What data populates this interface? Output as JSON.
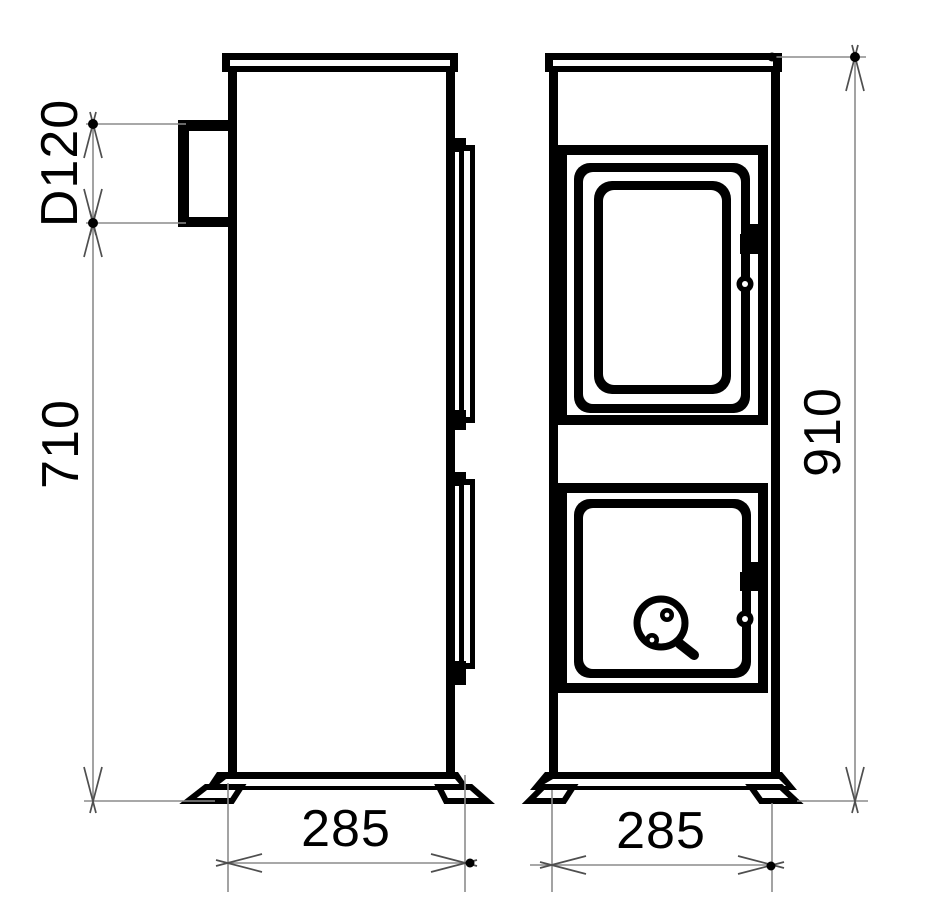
{
  "drawing": {
    "subject": "Two-view technical dimension drawing of a tall wood-burning stove",
    "views": [
      {
        "id": "side-view",
        "description": "left: side elevation with flue outlet collar and door edge profiles"
      },
      {
        "id": "front-view",
        "description": "right: front elevation with glazed upper door and lower ash door with air control knob"
      }
    ]
  },
  "dimensions": {
    "flue_diameter": {
      "label": "D120",
      "value": 120
    },
    "flue_height": {
      "label": "710",
      "value": 710
    },
    "overall_height": {
      "label": "910",
      "value": 910
    },
    "depth": {
      "label": "285",
      "value": 285
    },
    "width": {
      "label": "285",
      "value": 285
    }
  },
  "colors": {
    "background": "#ffffff",
    "drawing_line": "#000000",
    "dimension_line": "#8c8c8c",
    "arrow_line": "#4f4f4f",
    "text": "#000000"
  }
}
